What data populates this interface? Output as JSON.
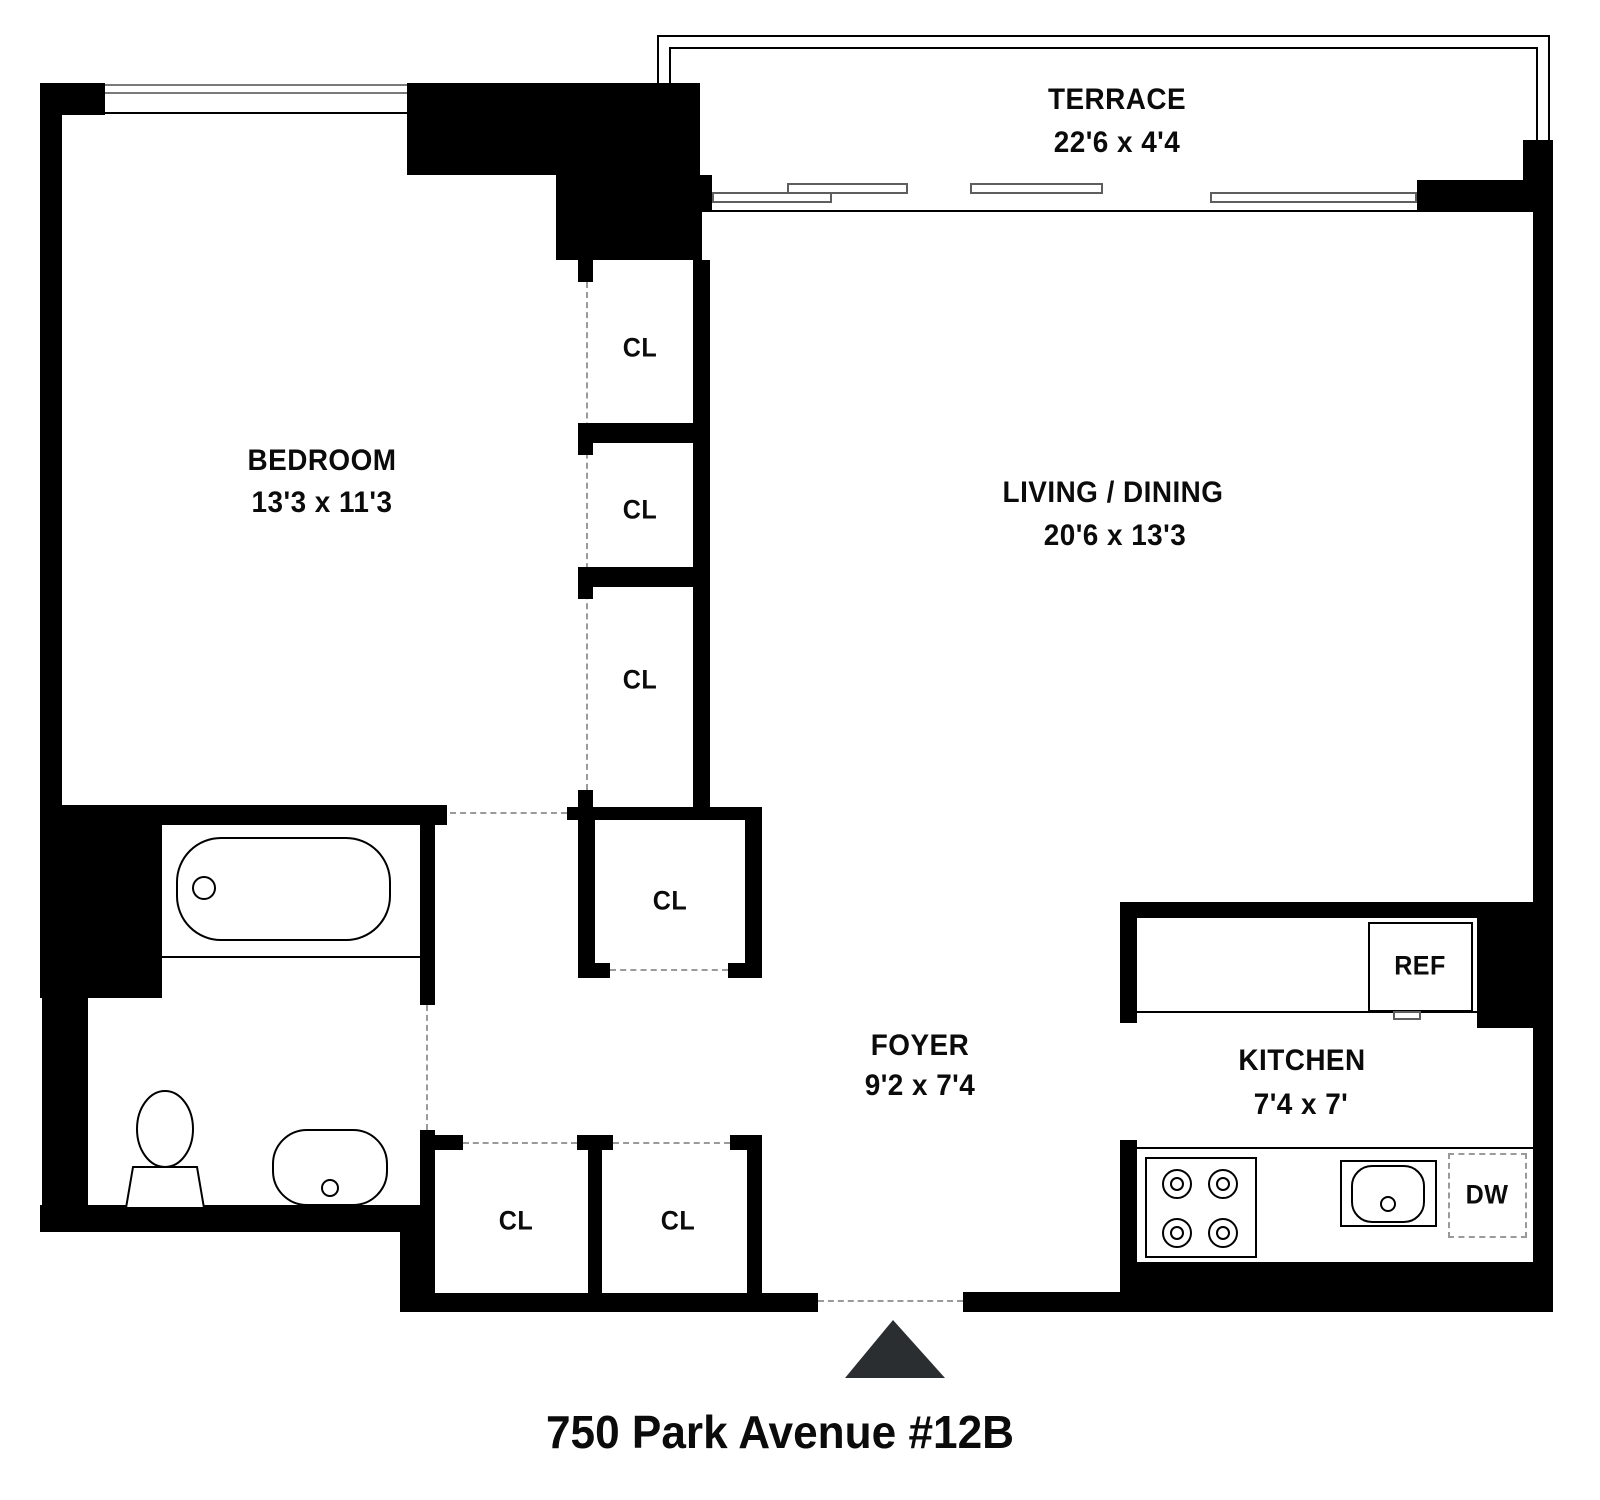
{
  "title": "750 Park Avenue #12B",
  "rooms": {
    "terrace": {
      "name": "TERRACE",
      "dims": "22'6 x 4'4"
    },
    "bedroom": {
      "name": "BEDROOM",
      "dims": "13'3 x 11'3"
    },
    "living_dining": {
      "name": "LIVING / DINING",
      "dims": "20'6 x 13'3"
    },
    "foyer": {
      "name": "FOYER",
      "dims": "9'2 x 7'4"
    },
    "kitchen": {
      "name": "KITCHEN",
      "dims": "7'4 x 7'"
    }
  },
  "labels": {
    "closet": "CL",
    "refrigerator": "REF",
    "dishwasher": "DW"
  },
  "colors": {
    "wall": "#000000",
    "window_line": "#7a7a7a",
    "dashed_line": "#9a9a9a",
    "entry_triangle": "#2b2e30",
    "background": "#ffffff"
  }
}
